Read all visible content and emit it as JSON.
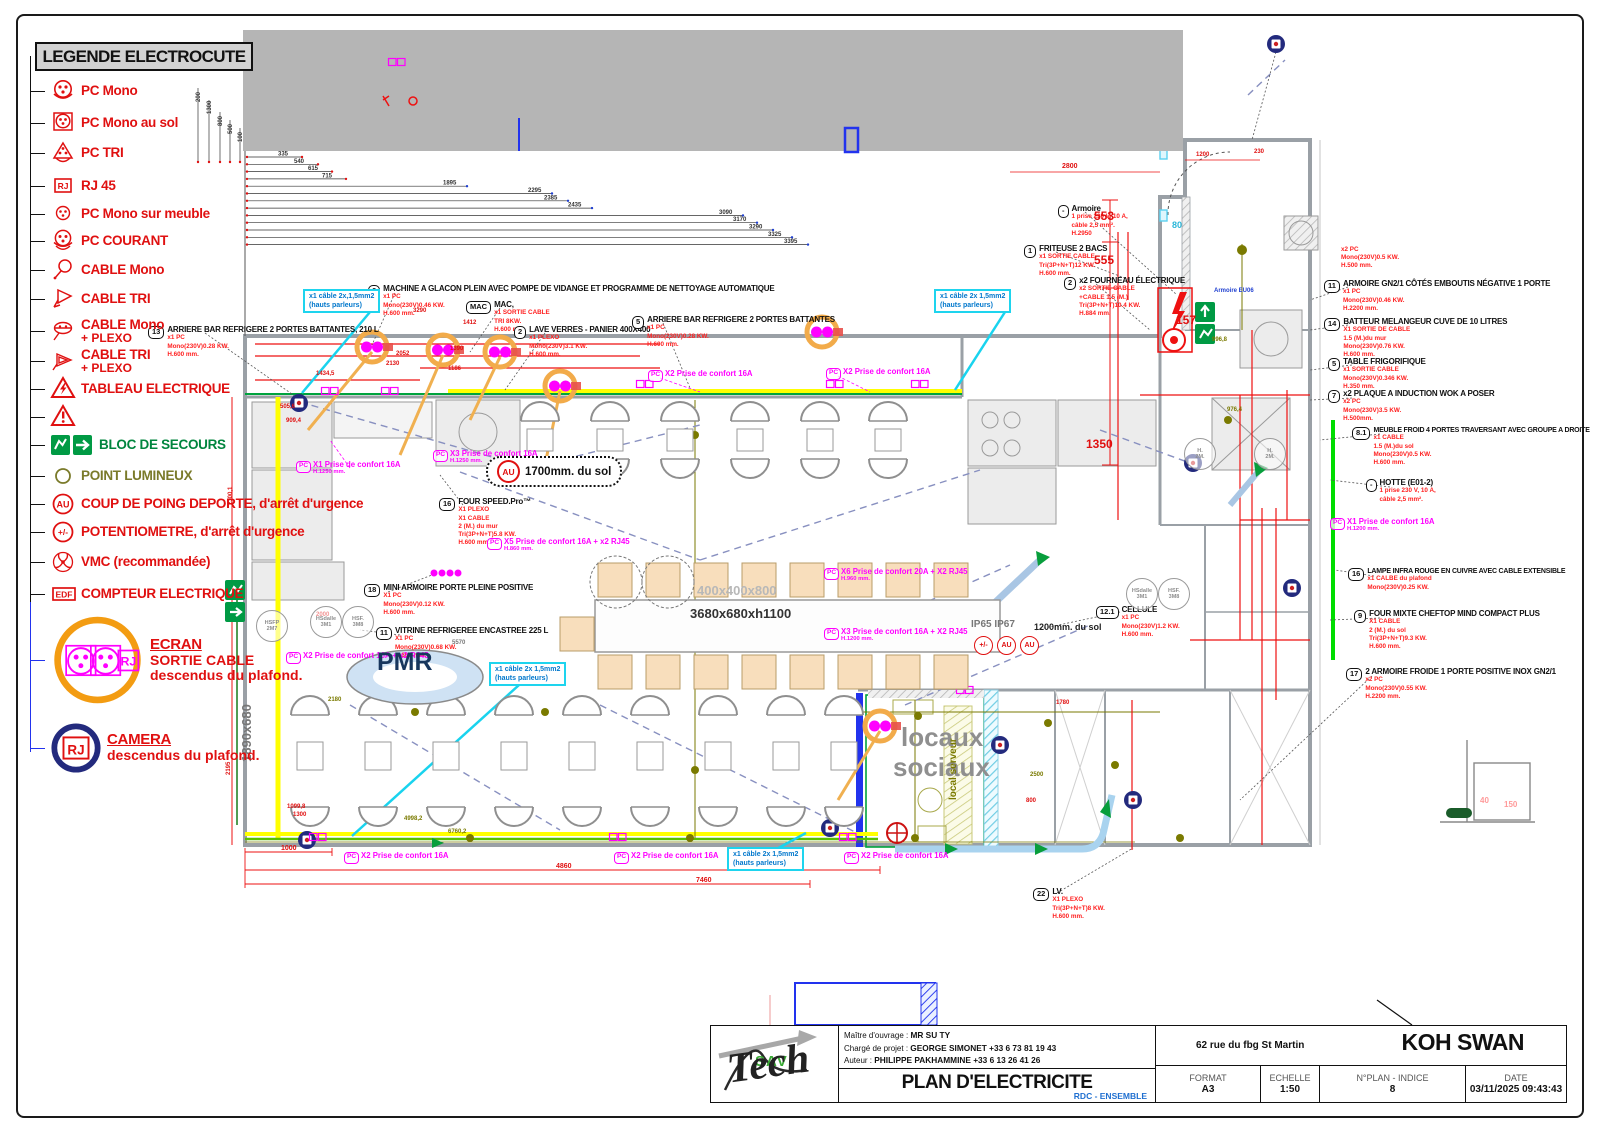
{
  "legend": {
    "title": "LEGENDE ELECTROCUTE",
    "items": [
      {
        "y": 78,
        "icon": "pc-mono",
        "label": "PC Mono"
      },
      {
        "y": 110,
        "icon": "pc-sol",
        "label": "PC Mono au sol"
      },
      {
        "y": 140,
        "icon": "pc-tri",
        "label": "PC TRI"
      },
      {
        "y": 173,
        "icon": "rj45",
        "label": "RJ 45"
      },
      {
        "y": 201,
        "icon": "pc-meuble",
        "label": "PC Mono sur meuble"
      },
      {
        "y": 228,
        "icon": "pc-courant",
        "label": "PC COURANT"
      },
      {
        "y": 257,
        "icon": "cable-mono",
        "label": "CABLE Mono"
      },
      {
        "y": 286,
        "icon": "cable-tri",
        "label": "CABLE TRI"
      },
      {
        "y": 318,
        "icon": "cable-mono-plexo",
        "label": "CABLE Mono",
        "sub": "+ PLEXO"
      },
      {
        "y": 348,
        "icon": "cable-tri-plexo",
        "label": "CABLE TRI",
        "sub": "+ PLEXO"
      },
      {
        "y": 376,
        "icon": "tableau",
        "label": "TABLEAU ELECTRIQUE"
      },
      {
        "y": 404,
        "icon": "warning",
        "label": ""
      },
      {
        "y": 432,
        "icon": "bloc",
        "wide": true,
        "label": "BLOC DE SECOURS",
        "color": "#00853e"
      },
      {
        "y": 463,
        "icon": "point",
        "label": "POINT LUMINEUX",
        "color": "#7a7a2a"
      },
      {
        "y": 491,
        "icon": "au",
        "label": "COUP DE POING DEPORTE, d'arrêt d'urgence"
      },
      {
        "y": 519,
        "icon": "potm",
        "label": "POTENTIOMETRE, d'arrêt d'urgence"
      },
      {
        "y": 549,
        "icon": "vmc",
        "label": "VMC (recommandée)"
      },
      {
        "y": 581,
        "icon": "edf",
        "label": "COMPTEUR ELECTRIQUE"
      },
      {
        "y": 614,
        "icon": "ecran",
        "big": true,
        "underline": true,
        "label": "ECRAN",
        "sub": "SORTIE CABLE\ndescendus du plafond."
      },
      {
        "y": 722,
        "icon": "camera",
        "big": true,
        "underline": true,
        "label": "CAMERA",
        "sub": "descendus du plafond."
      }
    ]
  },
  "dims": {
    "top_chain": [
      "335",
      "540",
      "615",
      "715",
      "1895",
      "2295",
      "2385",
      "2435",
      "3090",
      "3170",
      "3290",
      "3325",
      "3395"
    ],
    "left_chain": [
      "200",
      "1300",
      "800",
      "500",
      "100"
    ]
  },
  "callouts": [
    {
      "n": "13",
      "t": "ARRIERE BAR REFRIGERE 2 PORTES BATTANTES, 210 L",
      "l": [
        "x1 PC",
        "Mono(230V)0.28 KW.",
        "H.600 mm."
      ],
      "x": 148,
      "y": 326
    },
    {
      "n": "6",
      "t": "MACHINE A GLACON PLEIN AVEC POMPE DE VIDANGE ET PROGRAMME DE NETTOYAGE AUTOMATIQUE",
      "l": [
        "x1 PC",
        "Mono(230V)0.46 KW.",
        "H.600 mm."
      ],
      "x": 368,
      "y": 285
    },
    {
      "n": "MAC",
      "t": "MAC,",
      "l": [
        "x1 SORTIE CABLE",
        "TRI 8KW.",
        "H.600 mm."
      ],
      "x": 466,
      "y": 301
    },
    {
      "n": "2",
      "t": "LAVE VERRES - PANIER 400X400",
      "l": [
        "x1 PLEXO",
        "Mono(230V)3.1 KW.",
        "H.600 mm."
      ],
      "x": 514,
      "y": 326
    },
    {
      "n": "5",
      "t": "ARRIERE BAR REFRIGERE 2 PORTES BATTANTES",
      "l": [
        "x1 PC",
        "Mono(230V)0.28 KW.",
        "H.600 mm."
      ],
      "x": 632,
      "y": 316
    },
    {
      "n": "-",
      "t": "Armoire",
      "l": [
        "1 prise 230 V, 10 A,",
        "câble 2,5 mm².",
        "H.2950"
      ],
      "x": 1058,
      "y": 205
    },
    {
      "n": "1",
      "t": "FRITEUSE 2 BACS",
      "l": [
        "x1 SORTIE CABLE",
        "Tri(3P+N+T)12 KW.",
        "H.600 mm."
      ],
      "x": 1024,
      "y": 245
    },
    {
      "n": "2",
      "t": "x2 FOURNEAU ÉLECTRIQUE",
      "l": [
        "x2 SORTIE CABLE",
        "+CABLE 1.5 (M.)",
        "Tri(3P+N+T)10.4 KW.",
        "H.884 mm."
      ],
      "x": 1064,
      "y": 277
    },
    {
      "n": "11",
      "t": "ARMOIRE GN2/1 CÔTÉS EMBOUTIS NÉGATIVE 1 PORTE",
      "l": [
        "x1 PC",
        "Mono(230V)0.46 KW.",
        "H.2200 mm."
      ],
      "x": 1324,
      "y": 280
    },
    {
      "n": "14",
      "t": "BATTEUR MELANGEUR CUVE DE 10 LITRES",
      "l": [
        "X1 SORTIE DE CABLE",
        "1.5 (M.)du mur",
        "Mono(230V)0.76 KW.",
        "H.600 mm."
      ],
      "x": 1324,
      "y": 318
    },
    {
      "n": "5",
      "t": "TABLE FRIGORIFIQUE",
      "l": [
        "x1 SORTIE CABLE",
        "Mono(230V)0.346 KW.",
        "H.350 mm."
      ],
      "x": 1328,
      "y": 358
    },
    {
      "n": "7",
      "t": "x2 PLAQUE A INDUCTION WOK A POSER",
      "l": [
        "x2 PC",
        "Mono(230V)3.5 KW.",
        "H.500mm."
      ],
      "x": 1328,
      "y": 390
    },
    {
      "n": "8.1",
      "t": "MEUBLE FROID 4 PORTES TRAVERSANT AVEC GROUPE A DROITE",
      "l": [
        "x1 CABLE",
        "1.5 (M.)du sol",
        "Mono(230V)0.5 KW.",
        "H.600 mm."
      ],
      "x": 1352,
      "y": 427,
      "sm": true
    },
    {
      "n": "-",
      "t": "HOTTE (E01-2)",
      "l": [
        "1 prise 230 V, 10 A,",
        "câble 2,5 mm²."
      ],
      "x": 1366,
      "y": 479
    },
    {
      "n": "16",
      "t": "LAMPE INFRA ROUGE EN CUIVRE AVEC CABLE EXTENSIBLE",
      "l": [
        "x1 CALBE du plafond",
        "Mono(230V)0.25 KW."
      ],
      "x": 1348,
      "y": 568,
      "sm": true
    },
    {
      "n": "9",
      "t": "FOUR MIXTE CHEFTOP MIND COMPACT PLUS",
      "l": [
        "X1 CABLE",
        "2 (M.) du sol",
        "Tri(3P+N+T)9.3 KW.",
        "H.600 mm."
      ],
      "x": 1354,
      "y": 610
    },
    {
      "n": "17",
      "t": "2 ARMOIRE FROIDE 1 PORTE POSITIVE INOX GN2/1",
      "l": [
        "x2 PC",
        "Mono(230V)0.55 KW.",
        "H.2200 mm."
      ],
      "x": 1346,
      "y": 668
    },
    {
      "n": "16",
      "t": "FOUR SPEED.Pro™",
      "l": [
        "X1 PLEXO",
        "X1 CABLE",
        "2 (M.) du mur",
        "Tri(3P+N+T)5.8 KW.",
        "H.600 mm."
      ],
      "x": 439,
      "y": 498
    },
    {
      "n": "18",
      "t": "MINI ARMOIRE PORTE PLEINE POSITIVE",
      "l": [
        "X1 PC",
        "Mono(230V)0.12 KW.",
        "H.600 mm."
      ],
      "x": 364,
      "y": 584
    },
    {
      "n": "11",
      "t": "VITRINE REFRIGEREE ENCASTREE 225 L",
      "l": [
        "X1 PC",
        "Mono(230V)0.68 KW.",
        "H.600 mm."
      ],
      "x": 376,
      "y": 627
    },
    {
      "n": "12.1",
      "t": "CELLULE",
      "l": [
        "x1 PC",
        "Mono(230V)1.2 KW.",
        "H.600 mm."
      ],
      "x": 1096,
      "y": 606
    },
    {
      "n": "22",
      "t": "LV.",
      "l": [
        "X1 PLEXO",
        "Tri(3P+N+T)8 KW.",
        "H.600 mm."
      ],
      "x": 1033,
      "y": 888
    }
  ],
  "red_notes": [
    {
      "l": [
        "x2 PC",
        "Mono(230V)0.5 KW.",
        "H.500 mm."
      ],
      "x": 1341,
      "y": 246
    }
  ],
  "pc_labels": [
    {
      "t": "X2 Prise de confort 16A",
      "h": "",
      "x": 648,
      "y": 370
    },
    {
      "t": "X2 Prise de confort 16A",
      "h": "",
      "x": 826,
      "y": 368
    },
    {
      "t": "X1 Prise de confort 16A",
      "h": "H.1250 mm.",
      "x": 296,
      "y": 461
    },
    {
      "t": "X3 Prise de confort 16A",
      "h": "H.1250 mm.",
      "x": 433,
      "y": 450
    },
    {
      "t": "X5 Prise de confort 16A + x2 RJ45",
      "h": "H.860 mm.",
      "x": 487,
      "y": 538
    },
    {
      "t": "X6 Prise de confort 20A + X2 RJ45",
      "h": "H.960 mm.",
      "x": 824,
      "y": 568
    },
    {
      "t": "X3 Prise de confort 16A + X2 RJ45",
      "h": "H.1200 mm.",
      "x": 824,
      "y": 628
    },
    {
      "t": "X2 Prise de confort 16A + x2 RJ45",
      "h": "",
      "x": 286,
      "y": 652
    },
    {
      "t": "X1 Prise de confort 16A",
      "h": "H.1200 mm.",
      "x": 1330,
      "y": 518
    },
    {
      "t": "X2 Prise de confort 16A",
      "h": "",
      "x": 344,
      "y": 852
    },
    {
      "t": "X2 Prise de confort 16A",
      "h": "",
      "x": 614,
      "y": 852
    },
    {
      "t": "X2 Prise de confort 16A",
      "h": "",
      "x": 844,
      "y": 852
    }
  ],
  "cyan_notes": [
    {
      "l1": "x1 câble 2x,1,5mm2",
      "l2": "(hauts parleurs)",
      "x": 303,
      "y": 289
    },
    {
      "l1": "x1 câble 2x 1,5mm2",
      "l2": "(hauts parleurs)",
      "x": 934,
      "y": 289
    },
    {
      "l1": "x1 câble 2x 1,5mm2",
      "l2": "(hauts parleurs)",
      "x": 489,
      "y": 662
    },
    {
      "l1": "x1 câble 2x 1,5mm2",
      "l2": "(hauts parleurs)",
      "x": 727,
      "y": 847
    }
  ],
  "cloud_note": {
    "badge": "AU",
    "text": "1700mm. du sol",
    "x": 486,
    "y": 456
  },
  "symbol_row": {
    "x": 974,
    "y": 636,
    "items": [
      "+/-",
      "AU",
      "AU"
    ]
  },
  "misc_labels": [
    {
      "t": "553",
      "x": 1094,
      "y": 210,
      "s": 12,
      "c": "r"
    },
    {
      "t": "555",
      "x": 1094,
      "y": 254,
      "s": 12,
      "c": "r"
    },
    {
      "t": "1350",
      "x": 1086,
      "y": 438,
      "s": 12,
      "c": "r"
    },
    {
      "t": "157",
      "x": 1176,
      "y": 314,
      "s": 12,
      "c": "r"
    },
    {
      "t": "Armoire EU06",
      "x": 1214,
      "y": 288,
      "s": 6,
      "c": "b"
    },
    {
      "t": "80",
      "x": 1172,
      "y": 221,
      "s": 9,
      "c": "c"
    },
    {
      "t": "IP65 IP67",
      "x": 971,
      "y": 620,
      "s": 10,
      "c": "G"
    },
    {
      "t": "1200mm. du sol",
      "x": 1034,
      "y": 623,
      "s": 9,
      "c": "k"
    },
    {
      "t": "locaux",
      "x": 901,
      "y": 724,
      "s": 26,
      "c": "s"
    },
    {
      "t": "sociaux",
      "x": 893,
      "y": 754,
      "s": 26,
      "c": "s"
    },
    {
      "t": "PMR",
      "x": 377,
      "y": 650,
      "s": 25,
      "c": "#17365d"
    },
    {
      "t": "local serveur",
      "x": 949,
      "y": 800,
      "s": 10,
      "c": "o",
      "rot": -90
    },
    {
      "t": "1890x680",
      "x": 240,
      "y": 762,
      "s": 13,
      "c": "G",
      "rot": -90
    },
    {
      "t": "400x400x800",
      "x": 697,
      "y": 584,
      "s": 13,
      "c": "#b8b8b8"
    },
    {
      "t": "3680x680xh1100",
      "x": 690,
      "y": 607,
      "s": 13,
      "c": "#333"
    },
    {
      "t": "1000",
      "x": 281,
      "y": 845,
      "s": 7,
      "c": "r"
    },
    {
      "t": "4860",
      "x": 556,
      "y": 863,
      "s": 7,
      "c": "r"
    },
    {
      "t": "7460",
      "x": 696,
      "y": 877,
      "s": 7,
      "c": "r"
    },
    {
      "t": "6760,2",
      "x": 448,
      "y": 829,
      "s": 6,
      "c": "o"
    },
    {
      "t": "4998,2",
      "x": 404,
      "y": 816,
      "s": 6,
      "c": "o"
    },
    {
      "t": "2195",
      "x": 226,
      "y": 775,
      "s": 6,
      "c": "r",
      "rot": -90
    },
    {
      "t": "2300,1",
      "x": 228,
      "y": 505,
      "s": 6,
      "c": "r",
      "rot": -90
    },
    {
      "t": "976,4",
      "x": 1227,
      "y": 407,
      "s": 6,
      "c": "o"
    },
    {
      "t": "996,8",
      "x": 1212,
      "y": 337,
      "s": 6,
      "c": "o"
    },
    {
      "t": "2800",
      "x": 1062,
      "y": 163,
      "s": 7,
      "c": "r"
    },
    {
      "t": "1200",
      "x": 1196,
      "y": 152,
      "s": 6,
      "c": "r"
    },
    {
      "t": "230",
      "x": 1254,
      "y": 149,
      "s": 6,
      "c": "r"
    },
    {
      "t": "1780",
      "x": 1056,
      "y": 700,
      "s": 6,
      "c": "r"
    },
    {
      "t": "2500",
      "x": 1030,
      "y": 772,
      "s": 6,
      "c": "o"
    },
    {
      "t": "800",
      "x": 1026,
      "y": 798,
      "s": 6,
      "c": "r"
    },
    {
      "t": "40",
      "x": 1480,
      "y": 797,
      "s": 8,
      "c": "p"
    },
    {
      "t": "150",
      "x": 1504,
      "y": 801,
      "s": 8,
      "c": "p"
    },
    {
      "t": "3290",
      "x": 413,
      "y": 308,
      "s": 6,
      "c": "r"
    },
    {
      "t": "1412",
      "x": 463,
      "y": 320,
      "s": 6,
      "c": "r"
    },
    {
      "t": "2052",
      "x": 396,
      "y": 351,
      "s": 6,
      "c": "r"
    },
    {
      "t": "2130",
      "x": 386,
      "y": 361,
      "s": 6,
      "c": "r"
    },
    {
      "t": "1390",
      "x": 450,
      "y": 346,
      "s": 6,
      "c": "r"
    },
    {
      "t": "1186",
      "x": 448,
      "y": 366,
      "s": 6,
      "c": "r"
    },
    {
      "t": "1434,5",
      "x": 316,
      "y": 371,
      "s": 6,
      "c": "r"
    },
    {
      "t": "2000",
      "x": 316,
      "y": 612,
      "s": 6,
      "c": "r"
    },
    {
      "t": "5570",
      "x": 452,
      "y": 640,
      "s": 6,
      "c": "G"
    },
    {
      "t": "2180",
      "x": 328,
      "y": 697,
      "s": 6,
      "c": "o"
    },
    {
      "t": "1099,8",
      "x": 287,
      "y": 804,
      "s": 6,
      "c": "r"
    },
    {
      "t": "1300",
      "x": 293,
      "y": 812,
      "s": 6,
      "c": "r"
    },
    {
      "t": "909,4",
      "x": 286,
      "y": 418,
      "s": 6,
      "c": "r"
    },
    {
      "t": "505,6",
      "x": 280,
      "y": 404,
      "s": 6,
      "c": "r"
    }
  ],
  "circle_labels": [
    {
      "a": "HSFP",
      "b": "2M7",
      "x": 256,
      "y": 610
    },
    {
      "a": "HSdalle",
      "b": "3M1",
      "x": 310,
      "y": 606
    },
    {
      "a": "HSF.",
      "b": "3M8",
      "x": 342,
      "y": 606
    },
    {
      "a": "HSdalle",
      "b": "3M1",
      "x": 1126,
      "y": 578
    },
    {
      "a": "HSF.",
      "b": "3M8",
      "x": 1158,
      "y": 578
    },
    {
      "a": "H.",
      "b": "2M.",
      "x": 1184,
      "y": 438
    },
    {
      "a": "H.",
      "b": "2M.",
      "x": 1254,
      "y": 438
    }
  ],
  "title_block": {
    "logo_top": "SAV",
    "logo_script": "Tech",
    "owner_label": "Maître d'ouvrage :",
    "owner": "MR SU TY",
    "manager_label": "Chargé de projet :",
    "manager": "GEORGE SIMONET +33 6 73 81 19 43",
    "author_label": "Auteur :",
    "author": "PHILIPPE PAKHAMMINE +33 6 13 26 41 26",
    "doc_title": "PLAN D'ELECTRICITE",
    "doc_subtitle": "RDC - ENSEMBLE",
    "address": "62 rue du fbg St Martin",
    "project": "KOH SWAN",
    "format_label": "FORMAT",
    "format": "A3",
    "scale_label": "ECHELLE",
    "scale": "1:50",
    "plan_label": "N°PLAN - INDICE",
    "plan_num": "8",
    "date_label": "DATE",
    "date": "03/11/2025 09:43:43"
  }
}
